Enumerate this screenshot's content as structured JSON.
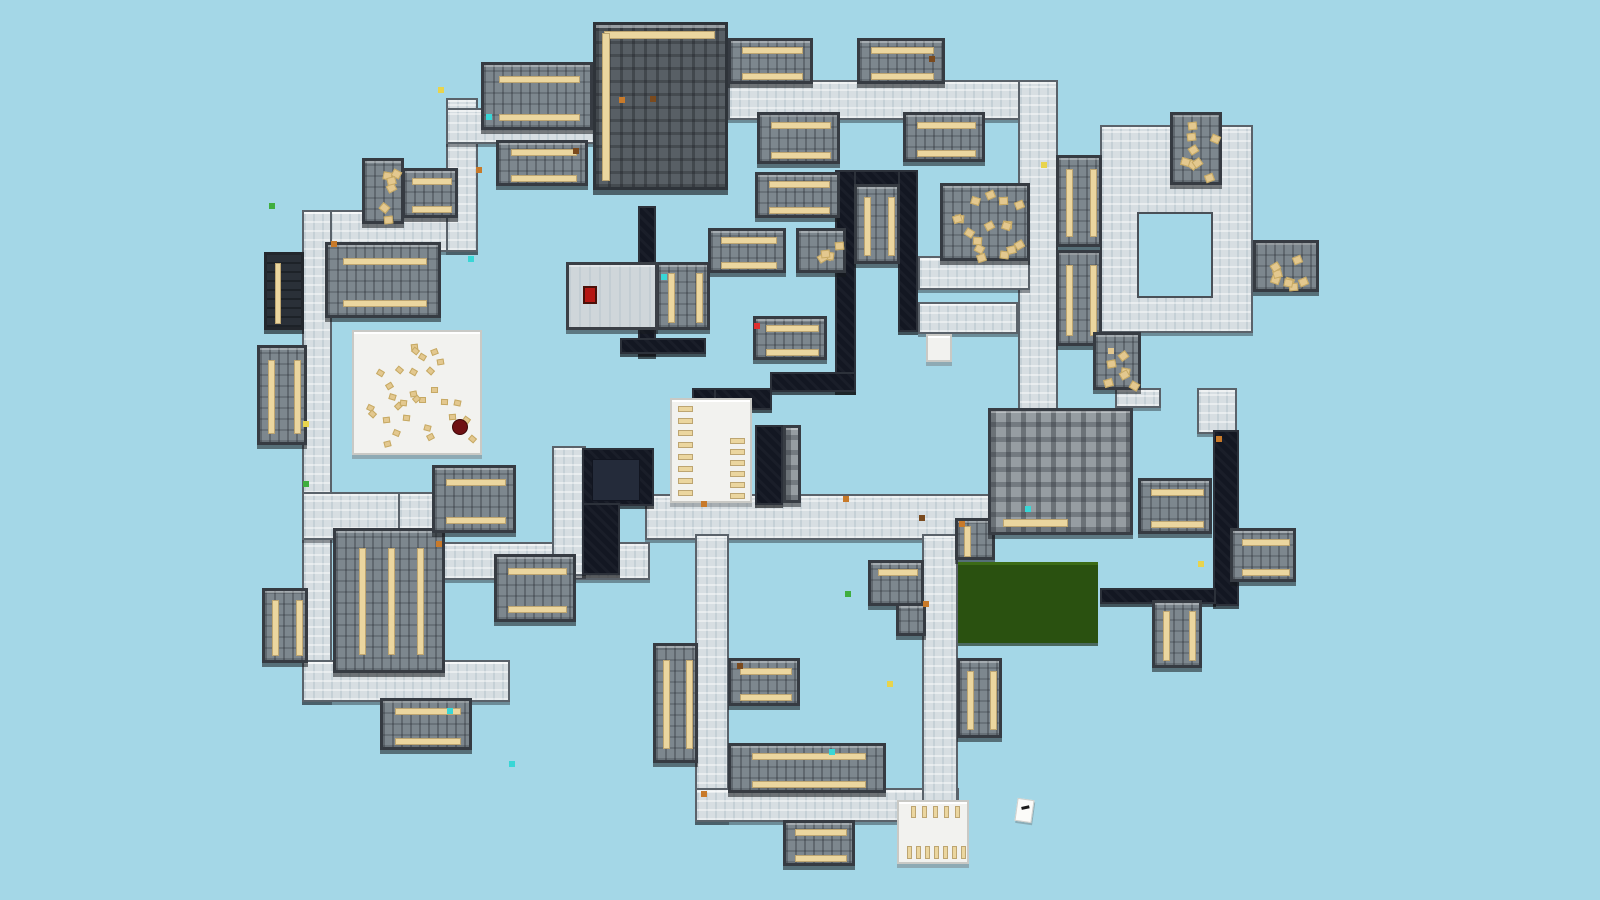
{
  "map": {
    "width": 1600,
    "height": 900,
    "background": "#a4d7e7",
    "note_text": "",
    "colors": {
      "hall_floor": "#d7dee2",
      "classroom_floor": "#7d878e",
      "library_floor": "#585f65",
      "dark_room": "#131722",
      "white_room": "#f2f2ef",
      "table_tan": "#ebd69f",
      "field_green": "#2a5110",
      "route_red": "#ee1c25",
      "sky_background": "#a4d7e7"
    },
    "hallways": [
      [
        302,
        210,
        176,
        42
      ],
      [
        302,
        210,
        30,
        492
      ],
      [
        446,
        98,
        32,
        154
      ],
      [
        446,
        108,
        150,
        36
      ],
      [
        728,
        80,
        314,
        40
      ],
      [
        1018,
        80,
        40,
        334
      ],
      [
        645,
        494,
        346,
        46
      ],
      [
        302,
        492,
        134,
        48
      ],
      [
        398,
        492,
        36,
        92
      ],
      [
        398,
        542,
        252,
        38
      ],
      [
        302,
        660,
        208,
        42
      ],
      [
        695,
        534,
        34,
        288
      ],
      [
        695,
        788,
        264,
        34
      ],
      [
        922,
        534,
        36,
        288
      ],
      [
        552,
        446,
        34,
        130
      ],
      [
        918,
        256,
        112,
        34
      ],
      [
        918,
        302,
        100,
        32
      ],
      [
        1100,
        125,
        153,
        208
      ],
      [
        1115,
        388,
        46,
        20
      ],
      [
        1197,
        388,
        40,
        46
      ]
    ],
    "courtyards": [
      [
        1137,
        212,
        76,
        86
      ]
    ],
    "dark_rooms": [
      [
        836,
        170,
        82,
        16
      ],
      [
        835,
        170,
        21,
        222
      ],
      [
        898,
        170,
        20,
        162
      ],
      [
        770,
        372,
        86,
        20
      ],
      [
        692,
        388,
        80,
        22
      ],
      [
        692,
        388,
        24,
        48
      ],
      [
        755,
        425,
        28,
        80
      ],
      [
        638,
        206,
        18,
        150
      ],
      [
        620,
        338,
        86,
        16
      ],
      [
        582,
        448,
        72,
        58
      ],
      [
        582,
        503,
        38,
        72
      ],
      [
        1213,
        430,
        26,
        176
      ],
      [
        1100,
        588,
        116,
        16
      ]
    ],
    "dark_inner_rooms": [
      [
        592,
        459,
        48,
        42
      ]
    ],
    "rooms": [
      [
        402,
        168,
        56,
        50,
        "class",
        2
      ],
      [
        325,
        242,
        116,
        76,
        "class",
        2
      ],
      [
        481,
        62,
        112,
        68,
        "class",
        2
      ],
      [
        496,
        140,
        92,
        46,
        "class",
        2
      ],
      [
        728,
        38,
        85,
        46,
        "class",
        2
      ],
      [
        857,
        38,
        88,
        46,
        "class",
        2
      ],
      [
        757,
        112,
        83,
        52,
        "class",
        2
      ],
      [
        903,
        112,
        82,
        50,
        "class",
        2
      ],
      [
        755,
        172,
        85,
        46,
        "class",
        2
      ],
      [
        708,
        228,
        78,
        45,
        "class",
        2
      ],
      [
        753,
        316,
        74,
        44,
        "class",
        2
      ],
      [
        656,
        262,
        54,
        68,
        "classv",
        2
      ],
      [
        854,
        184,
        46,
        80,
        "classv",
        2
      ],
      [
        1056,
        155,
        46,
        92,
        "classv",
        2
      ],
      [
        1056,
        250,
        46,
        96,
        "classv",
        2
      ],
      [
        1138,
        478,
        74,
        56,
        "class",
        2
      ],
      [
        1230,
        528,
        66,
        54,
        "class",
        2
      ],
      [
        1152,
        600,
        50,
        68,
        "classv",
        2
      ],
      [
        257,
        345,
        50,
        100,
        "classv",
        2
      ],
      [
        262,
        588,
        46,
        75,
        "classv",
        2
      ],
      [
        333,
        528,
        112,
        145,
        "classv",
        3
      ],
      [
        494,
        554,
        82,
        68,
        "class",
        2
      ],
      [
        380,
        698,
        92,
        52,
        "class",
        2
      ],
      [
        432,
        465,
        84,
        68,
        "class",
        2
      ],
      [
        728,
        658,
        72,
        48,
        "class",
        2
      ],
      [
        868,
        560,
        56,
        46,
        "class",
        1
      ],
      [
        896,
        603,
        30,
        33,
        "class",
        0
      ],
      [
        728,
        743,
        158,
        50,
        "class",
        2
      ],
      [
        653,
        643,
        45,
        120,
        "classv",
        2
      ],
      [
        957,
        658,
        45,
        80,
        "classv",
        2
      ],
      [
        783,
        820,
        72,
        46,
        "class",
        2
      ],
      [
        955,
        518,
        40,
        42,
        "classv",
        1
      ],
      [
        264,
        252,
        40,
        78,
        "darkclass",
        1
      ],
      [
        783,
        425,
        18,
        78,
        "grid",
        0
      ],
      [
        1093,
        332,
        48,
        58,
        "art",
        0
      ],
      [
        940,
        183,
        90,
        78,
        "art",
        0
      ],
      [
        1170,
        112,
        52,
        73,
        "art",
        0
      ],
      [
        1253,
        240,
        66,
        52,
        "art",
        0
      ],
      [
        796,
        228,
        50,
        45,
        "art",
        0
      ],
      [
        362,
        158,
        42,
        66,
        "art",
        0
      ],
      [
        988,
        408,
        145,
        127,
        "gridt",
        0
      ],
      [
        593,
        22,
        135,
        168,
        "lib",
        0
      ],
      [
        566,
        262,
        92,
        68,
        "light",
        0
      ],
      [
        352,
        330,
        130,
        125,
        "gym",
        0
      ],
      [
        670,
        398,
        82,
        105,
        "caf",
        0
      ],
      [
        897,
        800,
        72,
        64,
        "rest",
        0
      ],
      [
        926,
        334,
        26,
        28,
        "white",
        0
      ],
      [
        958,
        562,
        140,
        81,
        "field",
        0
      ]
    ],
    "objects": {
      "podium_red": [
        583,
        286,
        14,
        18
      ],
      "gym_ball_dark_red": [
        452,
        419,
        16,
        16
      ],
      "paper_icon": [
        1016,
        799,
        17,
        23
      ]
    },
    "specks": [
      [
        468,
        256,
        "#39d6d6"
      ],
      [
        486,
        114,
        "#39d6d6"
      ],
      [
        573,
        148,
        "#7a4a1e"
      ],
      [
        661,
        274,
        "#39d6d6"
      ],
      [
        737,
        663,
        "#7a4a1e"
      ],
      [
        829,
        749,
        "#39d6d6"
      ],
      [
        509,
        761,
        "#39d6d6"
      ],
      [
        1025,
        506,
        "#39d6d6"
      ],
      [
        447,
        708,
        "#39d6d6"
      ],
      [
        269,
        203,
        "#3fae3f"
      ],
      [
        438,
        87,
        "#e8d44d"
      ],
      [
        929,
        56,
        "#7a4a1e"
      ],
      [
        754,
        323,
        "#e03030"
      ],
      [
        919,
        515,
        "#7a4a1e"
      ],
      [
        331,
        241,
        "#c87a2a"
      ],
      [
        476,
        167,
        "#c87a2a"
      ],
      [
        619,
        97,
        "#c87a2a"
      ],
      [
        701,
        501,
        "#c87a2a"
      ],
      [
        843,
        496,
        "#c87a2a"
      ],
      [
        959,
        521,
        "#c87a2a"
      ],
      [
        1041,
        162,
        "#e8d44d"
      ],
      [
        1216,
        436,
        "#c87a2a"
      ],
      [
        303,
        481,
        "#3fae3f"
      ],
      [
        436,
        541,
        "#c87a2a"
      ],
      [
        701,
        791,
        "#c87a2a"
      ],
      [
        923,
        601,
        "#c87a2a"
      ],
      [
        887,
        681,
        "#e8d44d"
      ],
      [
        1198,
        561,
        "#e8d44d"
      ],
      [
        303,
        421,
        "#e8d44d"
      ],
      [
        845,
        591,
        "#3fae3f"
      ],
      [
        650,
        96,
        "#7a4a1e"
      ],
      [
        1108,
        348,
        "#e3c88f"
      ]
    ],
    "route": {
      "color": "#ee1c25",
      "stroke_width": 8,
      "points": [
        [
          737,
          518
        ],
        [
          1012,
          517
        ],
        [
          1030,
          510
        ],
        [
          1038,
          488
        ],
        [
          1046,
          262
        ],
        [
          1044,
          112
        ],
        [
          1036,
          100
        ],
        [
          688,
          96
        ],
        [
          545,
          130
        ],
        [
          463,
          130
        ],
        [
          463,
          236
        ],
        [
          322,
          236
        ],
        [
          322,
          518
        ],
        [
          420,
          519
        ],
        [
          421,
          558
        ],
        [
          588,
          561
        ],
        [
          588,
          453
        ],
        [
          650,
          453
        ],
        [
          650,
          521
        ],
        [
          705,
          521
        ]
      ],
      "arrow_tip": [
        729,
        521
      ],
      "arrow_width": 25,
      "arrow_half_height": 18,
      "direction": "counter-clockwise"
    }
  }
}
